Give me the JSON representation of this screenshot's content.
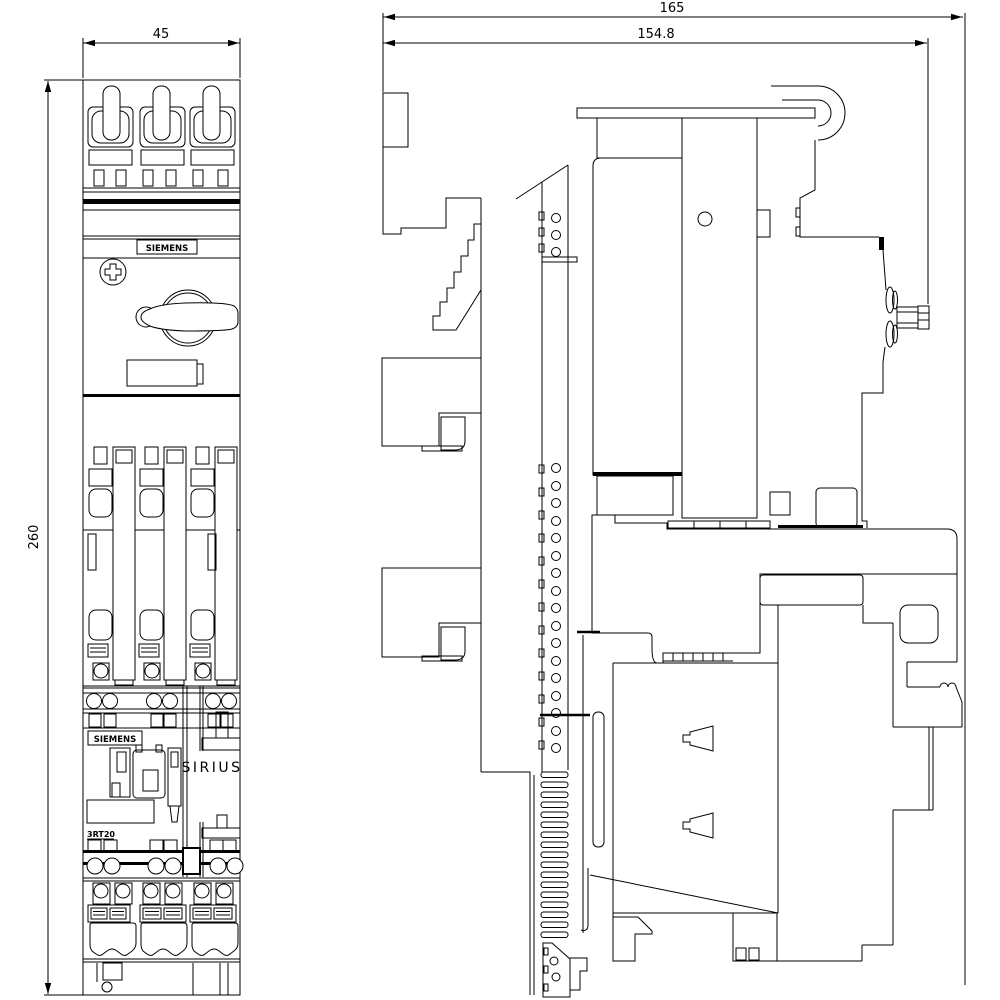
{
  "drawing": {
    "front_view": {
      "width_dim": "45",
      "height_dim": "260",
      "brand_label_top": "SIEMENS",
      "brand_label_bottom": "SIEMENS",
      "type_label": "3RT20"
    },
    "side_view": {
      "depth_dim_overall": "165",
      "depth_dim_body": "154.8",
      "family_label": "SIRIUS"
    },
    "colors": {
      "line": "#000000",
      "background": "#ffffff"
    }
  }
}
